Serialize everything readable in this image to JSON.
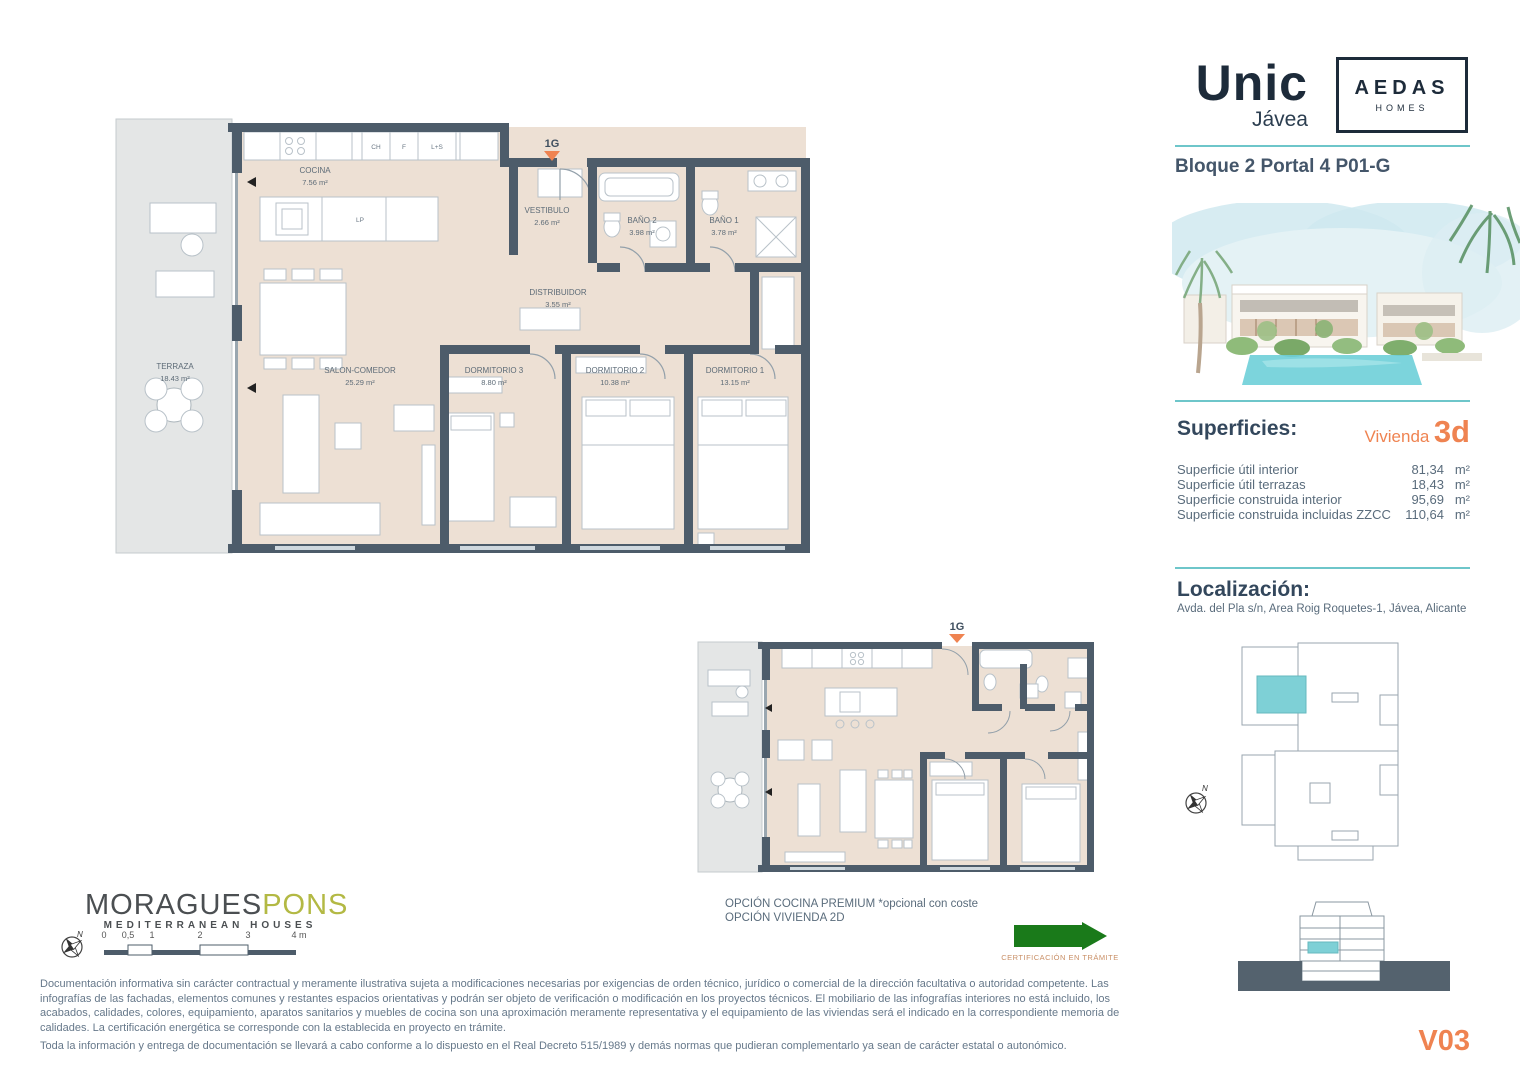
{
  "brand": {
    "name": "Unic",
    "location": "Jávea",
    "partner_name": "AEDAS",
    "partner_sub": "HOMES"
  },
  "header": {
    "title": "Bloque 2 Portal 4 P01-G"
  },
  "superficies": {
    "heading": "Superficies:",
    "vivienda_label": "Vivienda",
    "vivienda_code": "3d",
    "unit": "m²",
    "rows": [
      {
        "label": "Superficie útil interior",
        "value": "81,34"
      },
      {
        "label": "Superficie útil terrazas",
        "value": "18,43"
      },
      {
        "label": "Superficie construida interior",
        "value": "95,69"
      },
      {
        "label": "Superficie construida incluidas ZZCC",
        "value": "110,64"
      }
    ]
  },
  "localizacion": {
    "heading": "Localización:",
    "address": "Avda. del Pla s/n, Area Roig Roquetes-1, Jávea, Alicante"
  },
  "plan_main": {
    "entrance_label": "1G",
    "rooms": [
      {
        "name": "COCINA",
        "area": "7.56 m²"
      },
      {
        "name": "VESTIBULO",
        "area": "2.66 m²"
      },
      {
        "name": "BAÑO 2",
        "area": "3.98 m²"
      },
      {
        "name": "BAÑO 1",
        "area": "3.78 m²"
      },
      {
        "name": "DISTRIBUIDOR",
        "area": "3.55 m²"
      },
      {
        "name": "SALON-COMEDOR",
        "area": "25.29 m²"
      },
      {
        "name": "DORMITORIO 3",
        "area": "8.80 m²"
      },
      {
        "name": "DORMITORIO 2",
        "area": "10.38 m²"
      },
      {
        "name": "DORMITORIO 1",
        "area": "13.15 m²"
      },
      {
        "name": "TERRAZA",
        "area": "18.43 m²"
      }
    ],
    "fixtures": [
      "CH",
      "F",
      "L+S",
      "LP"
    ]
  },
  "plan_option": {
    "entrance_label": "1G",
    "caption_line1": "OPCIÓN COCINA PREMIUM *opcional con coste",
    "caption_line2": "OPCIÓN VIVIENDA 2D"
  },
  "certification": {
    "label": "CERTIFICACIÓN EN TRÁMITE"
  },
  "architect": {
    "name_primary": "MORAGUES",
    "name_secondary": "PONS",
    "tagline": "MEDITERRANEAN HOUSES"
  },
  "scalebar": {
    "ticks": [
      "0",
      "0,5",
      "1",
      "2",
      "3",
      "4 m"
    ]
  },
  "compass": {
    "label": "N"
  },
  "sheet": {
    "code": "V03"
  },
  "disclaimer": {
    "para1": "Documentación informativa sin carácter contractual y meramente ilustrativa sujeta a modificaciones necesarias por exigencias de orden técnico, jurídico o comercial de la dirección facultativa o autoridad competente. Las infografías de las fachadas, elementos comunes y restantes espacios orientativas y podrán ser objeto de verificación o modificación en los proyectos técnicos. El mobiliario de las infografías interiores no está incluido, los acabados, calidades, colores, equipamiento, aparatos sanitarios y muebles de cocina son una aproximación meramente representativa y el equipamiento de las viviendas será el indicado en la correspondiente memoria de calidades. La certificación energética se corresponde con la establecida en proyecto en trámite.",
    "para2": "Toda la información y entrega de documentación se llevará a cabo conforme a lo dispuesto en el Real Decreto 515/1989 y demás normas que pudieran complementarlo ya sean de carácter estatal o autonómico."
  },
  "colors": {
    "wall": "#4d5c6a",
    "floor": "#ede0d4",
    "terrace": "#e4e6e6",
    "accent_teal": "#6ec6ca",
    "accent_orange": "#ef8351",
    "unit_highlight": "#7ed0d6",
    "certification_green": "#1a7a1a"
  }
}
